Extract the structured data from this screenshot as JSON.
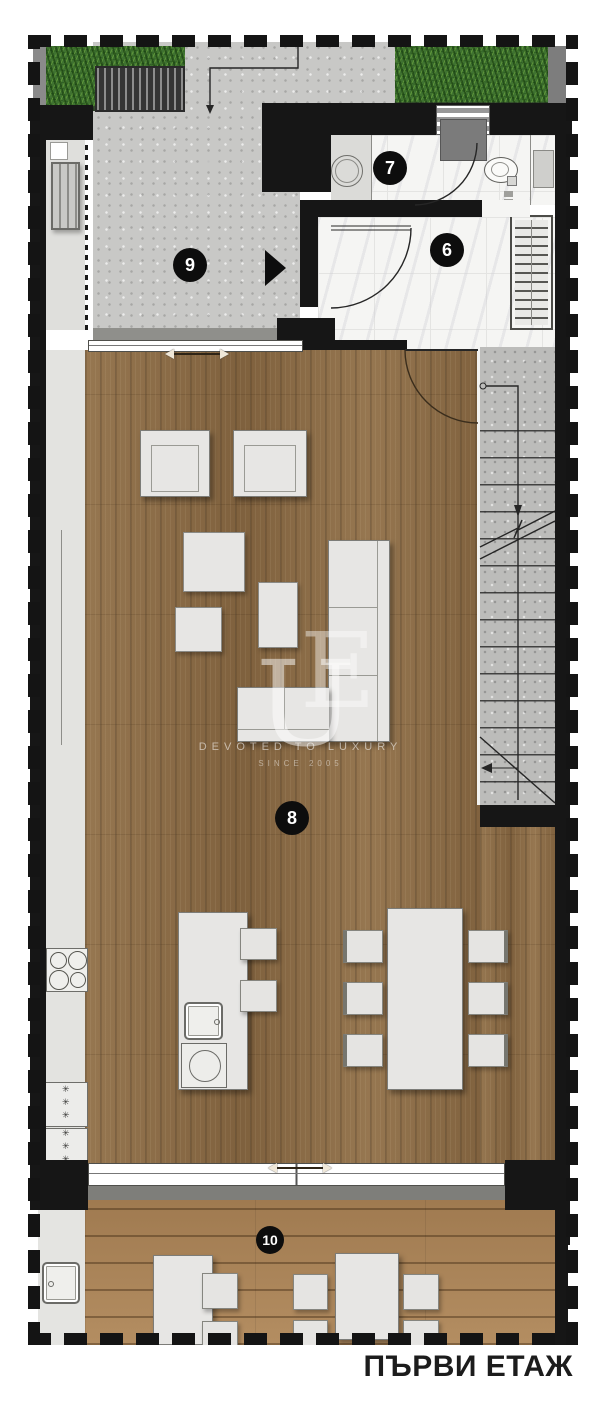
{
  "title": {
    "floor_label": "ПЪРВИ ЕТАЖ"
  },
  "watermark": {
    "letter_e": "E",
    "letter_u": "U",
    "tagline": "DEVOTED TO LUXURY",
    "since_line": "SINCE 2005"
  },
  "room_labels": {
    "hallway": "6",
    "bathroom": "7",
    "living_room": "8",
    "entry_courtyard": "9",
    "terrace": "10"
  },
  "appliances": {
    "freezer_marks": "✳✳✳"
  },
  "icons": {
    "entry_direction_arrow": "right-triangle",
    "sliding_door_arrow": "double-headed-horizontal",
    "stair_direction_arrow": "down-then-left"
  },
  "colors": {
    "wall": "#161616",
    "concrete": "#c8c8c6",
    "marble": "#f5f5f3",
    "living_wood": "#8a6b46",
    "terrace_deck": "#ab8458",
    "grass": "#3f7230",
    "furniture": "#e7e6e4",
    "label_bg": "#0d0d0d",
    "label_text": "#ffffff"
  }
}
